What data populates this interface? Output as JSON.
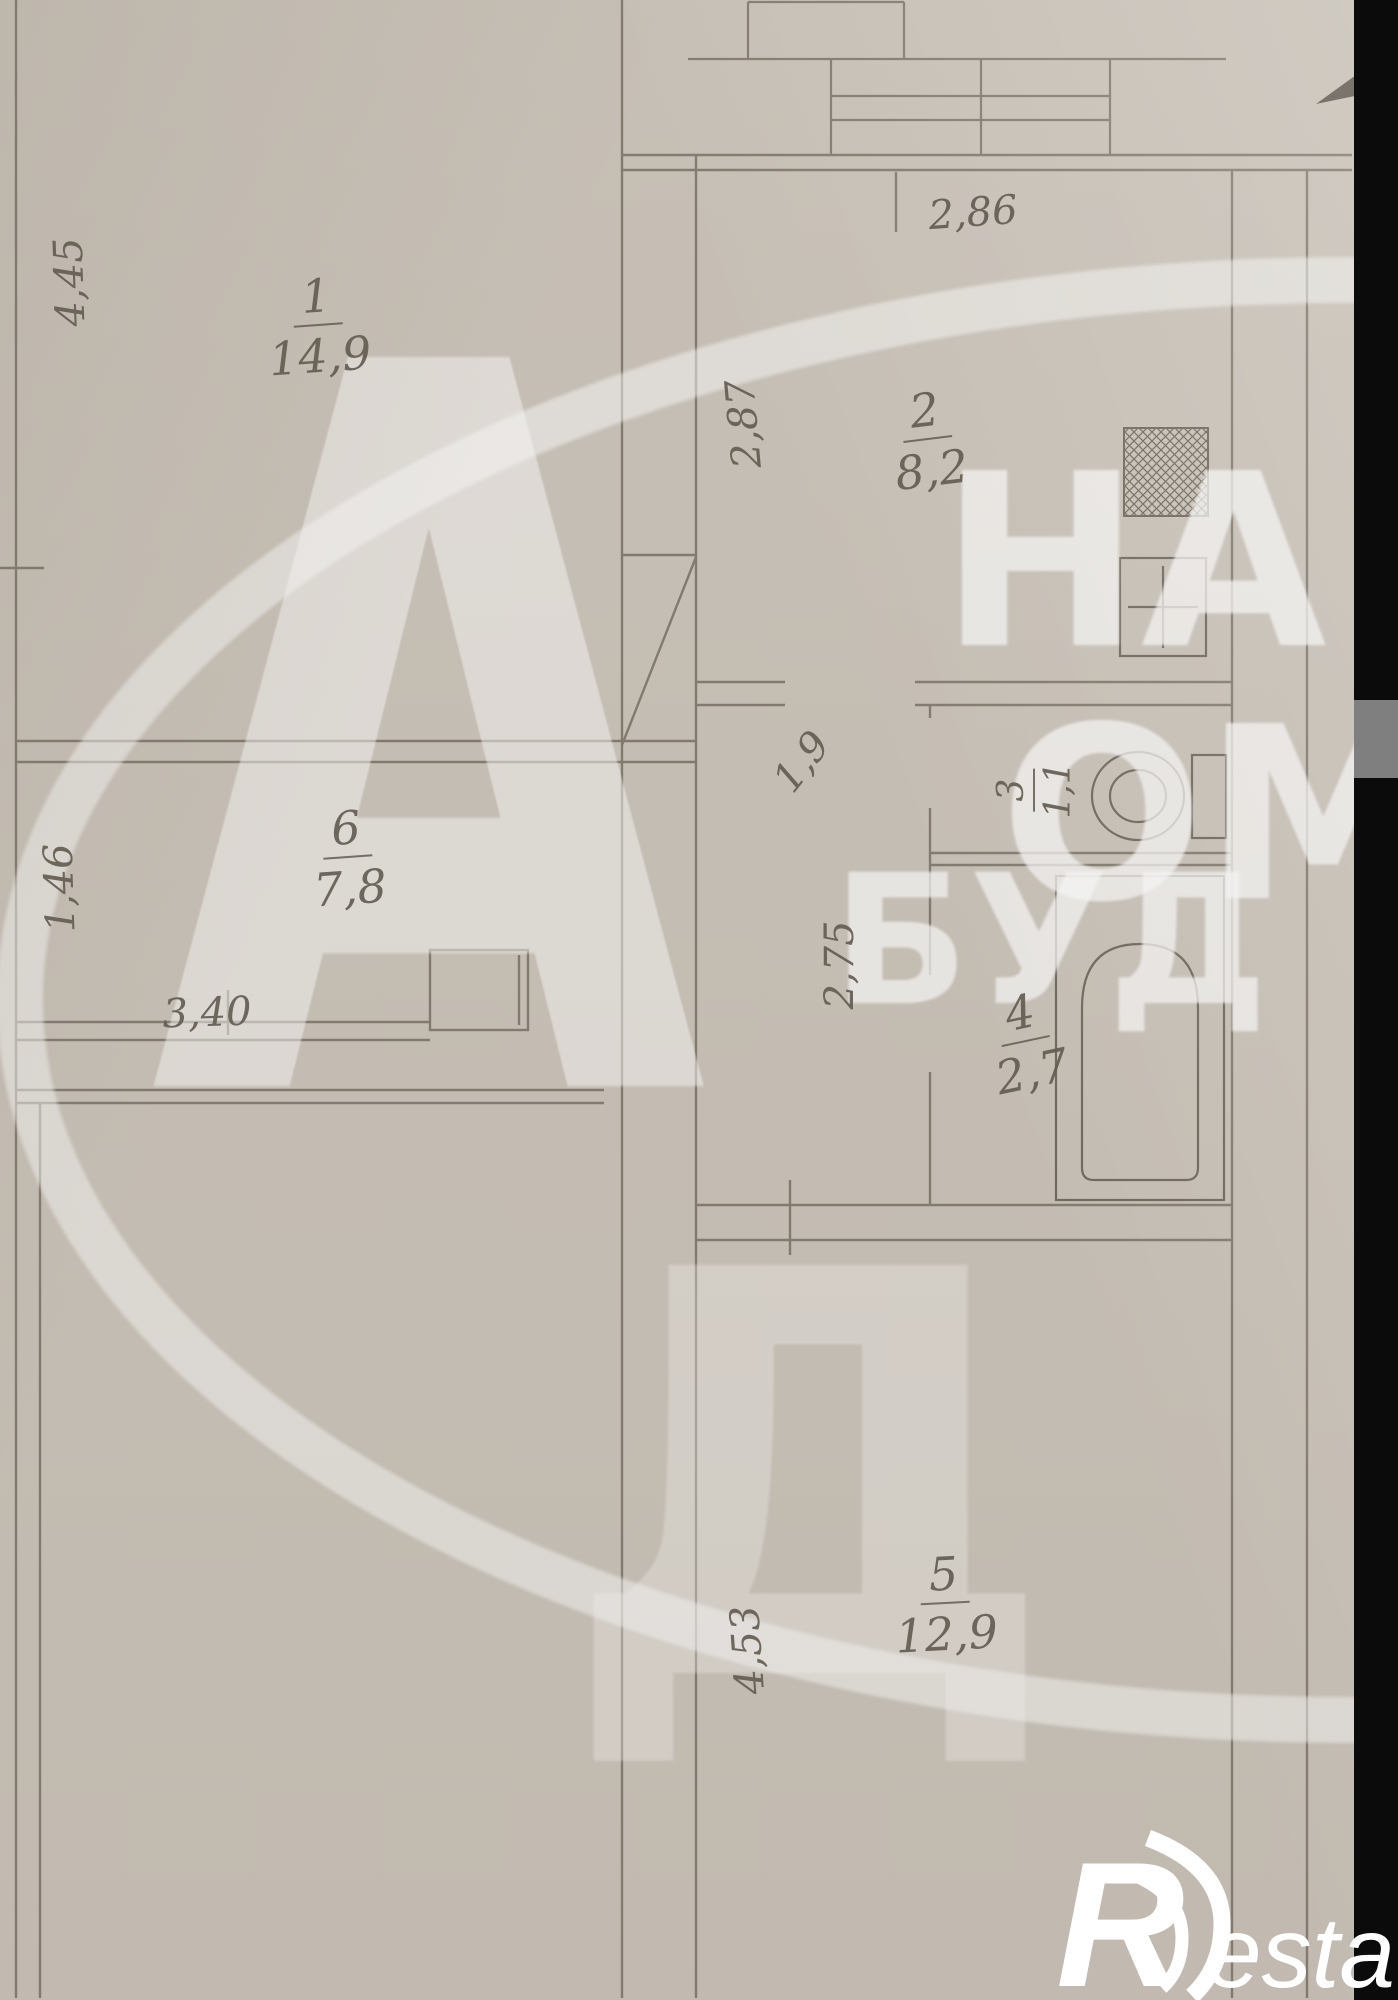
{
  "plan": {
    "rooms": [
      {
        "id": "room-1-living",
        "number": "1",
        "area": "14,9"
      },
      {
        "id": "room-2-kitchen",
        "number": "2",
        "area": "8,2"
      },
      {
        "id": "room-3-wc",
        "number": "3",
        "area": "1,1"
      },
      {
        "id": "room-4-bathroom",
        "number": "4",
        "area": "2,7"
      },
      {
        "id": "room-5-room",
        "number": "5",
        "area": "12,9"
      },
      {
        "id": "room-6-hall",
        "number": "6",
        "area": "7,8"
      }
    ],
    "dimensions": [
      {
        "value": "4,45"
      },
      {
        "value": "2,86"
      },
      {
        "value": "2,87"
      },
      {
        "value": "1,9"
      },
      {
        "value": "2,75"
      },
      {
        "value": "3,40"
      },
      {
        "value": "1,46"
      },
      {
        "value": "4,53"
      }
    ],
    "line_color": "#847c70",
    "paper_color": "#cbc4ba"
  },
  "watermark": {
    "letter_large": "А",
    "letter_large_2": "Д",
    "fragment_top": "НА",
    "fragment_middle": "ОМ",
    "fragment_bottom": "БУД",
    "color": "#ffffff"
  },
  "logo": {
    "initial": "R",
    "name": "estate"
  }
}
